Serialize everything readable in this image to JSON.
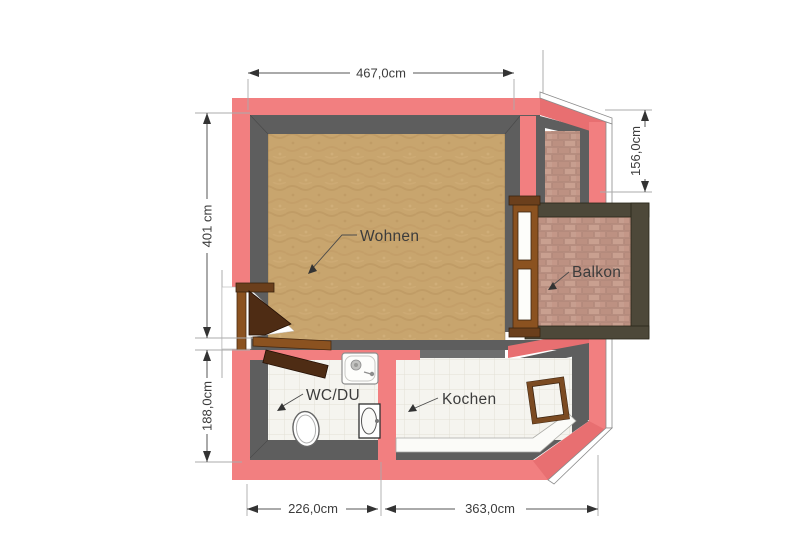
{
  "rooms": {
    "wohnen": {
      "label": "Wohnen"
    },
    "balkon": {
      "label": "Balkon"
    },
    "wc_du": {
      "label": "WC/DU"
    },
    "kochen": {
      "label": "Kochen"
    }
  },
  "dimensions": {
    "top_width": "467,0cm",
    "left_upper_height": "401 cm",
    "left_lower_height": "188,0cm",
    "right_height": "156,0cm",
    "bottom_left_width": "226,0cm",
    "bottom_right_width": "363,0cm"
  },
  "colors": {
    "background": "#FFFFFF",
    "wall_pink": "#F27F80",
    "wall_pink_dark": "#E86F71",
    "wall_gray": "#5E5E5E",
    "wood_floor": "#C8A56E",
    "brick_floor": "#C59B8D",
    "tile_floor": "#F5F4EF",
    "wood_frame": "#8B5220",
    "wood_dark": "#4E2C14",
    "rail_dark": "#4D4839",
    "dim_line": "#555555",
    "text": "#3C3C3C"
  }
}
